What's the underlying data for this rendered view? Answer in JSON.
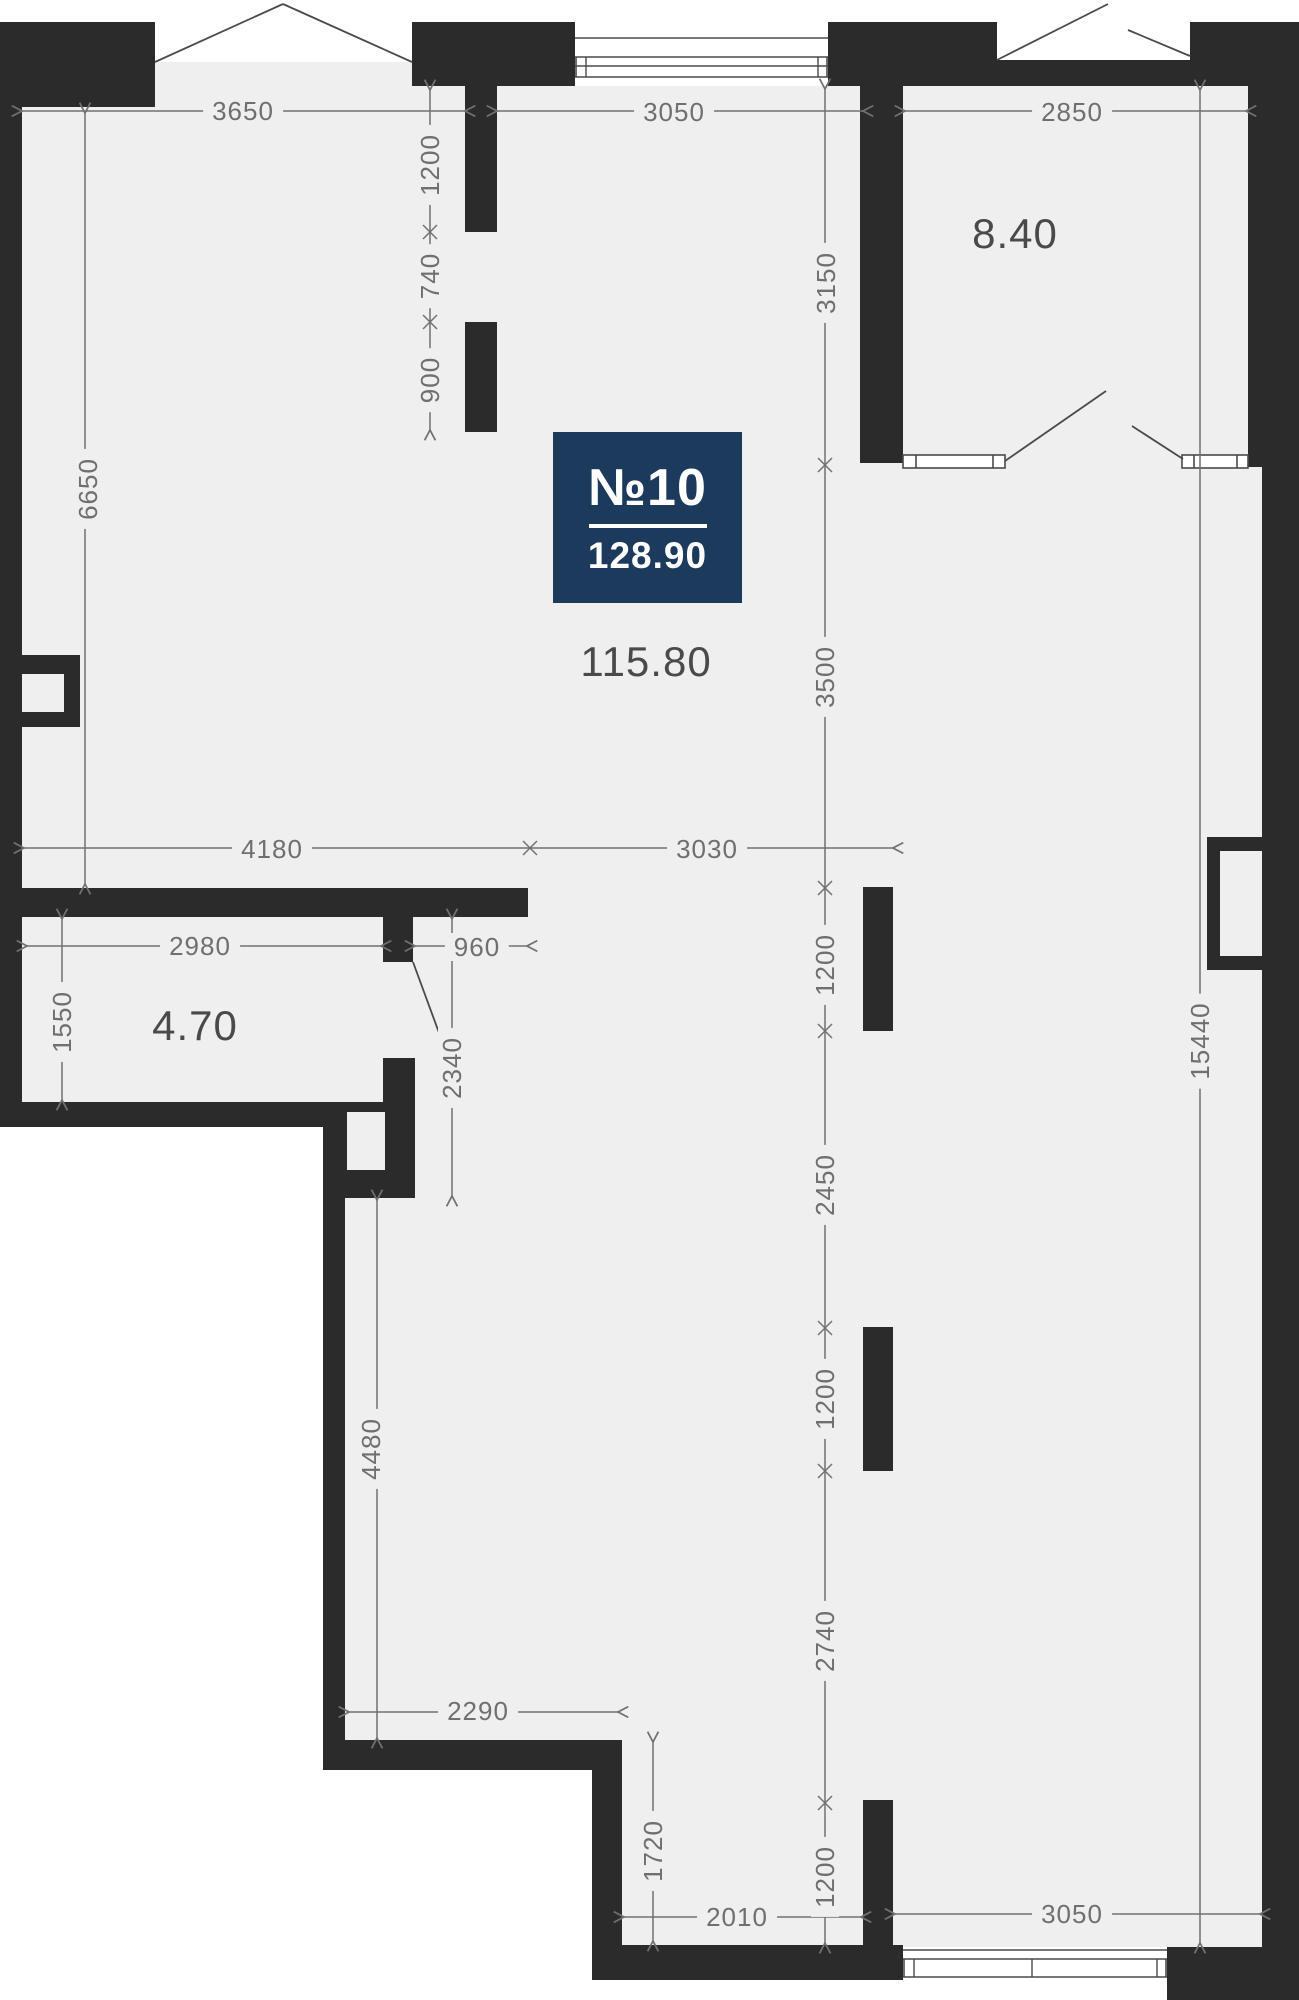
{
  "plan": {
    "unit_label": "№10",
    "total_area": "128.90",
    "rooms": [
      {
        "id": "main-room",
        "area": "115.80"
      },
      {
        "id": "loggia",
        "area": "8.40"
      },
      {
        "id": "bathroom",
        "area": "4.70"
      }
    ],
    "dims": {
      "top_width_left": "3650",
      "top_width_center": "3050",
      "top_width_loggia": "2850",
      "entry_wall_upper": "1200",
      "entry_wall_gap": "740",
      "entry_wall_lower": "900",
      "left_height": "6650",
      "loggia_height": "3150",
      "mid_height": "3500",
      "mid_width_left": "4180",
      "mid_width_right": "3030",
      "bath_width": "2980",
      "bath_door": "960",
      "bath_height": "1550",
      "passage_height": "2340",
      "col_upper": "1200",
      "seg_2450": "2450",
      "col_mid": "1200",
      "seg_2740": "2740",
      "col_lower": "1200",
      "lower_left_height": "4480",
      "lower_width": "2290",
      "step_height": "1720",
      "bottom_width_left": "2010",
      "bottom_width_right": "3050",
      "right_height": "15440"
    },
    "colors": {
      "wall": "#2b2b2b",
      "floor": "#efefef",
      "outside": "#ffffff",
      "dim_line": "#717171",
      "badge_bg": "#1b3a5c",
      "badge_text": "#ffffff",
      "area_text": "#4a4a4a"
    }
  }
}
